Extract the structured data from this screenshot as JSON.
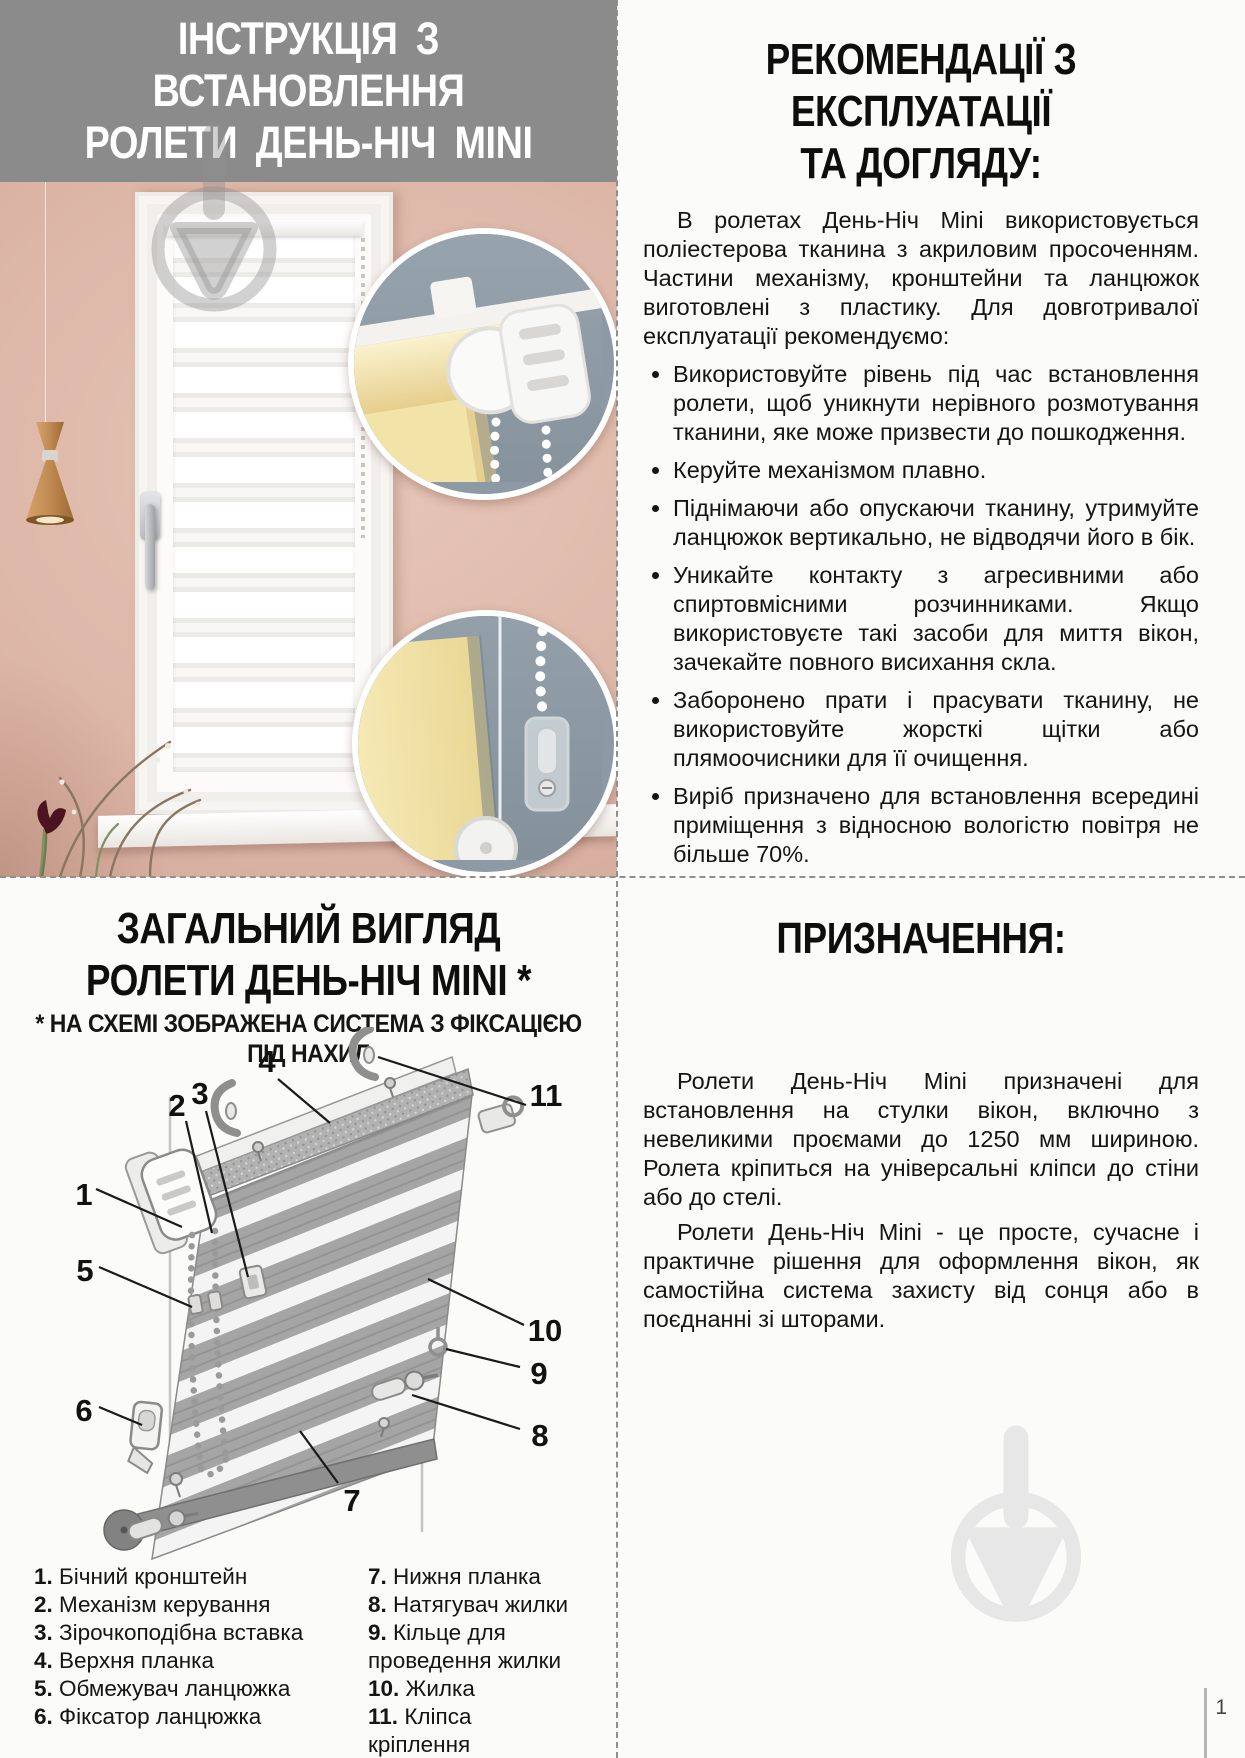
{
  "page": {
    "number": "1"
  },
  "colors": {
    "header_gray": "#8b8b8b",
    "wall_pink": "#dcb5a6",
    "inset_slate": "#8d99a4",
    "blind_yellow": "#f3e5ad",
    "watermark_gray": "#e9e9e9",
    "text": "#151515"
  },
  "install_header": {
    "line1": "ІНСТРУКЦІЯ З ВСТАНОВЛЕННЯ",
    "line2": "РОЛЕТИ ДЕНЬ-НІЧ MINI"
  },
  "recommendations": {
    "title_line1": "РЕКОМЕНДАЦІЇ З ЕКСПЛУАТАЦІЇ",
    "title_line2": "ТА ДОГЛЯДУ:",
    "intro": "В ролетах День-Ніч Mini використовується поліестерова тканина з акриловим просоченням. Частини механізму, кронштейни та ланцюжок виготовлені з пластику. Для довготривалої експлуатації рекомендуємо:",
    "bullets": [
      "Використовуйте рівень під час встановлення ролети, щоб уникнути нерівного розмотування тканини, яке може призвести до пошкодження.",
      "Керуйте механізмом плавно.",
      "Піднімаючи або опускаючи тканину, утримуйте ланцюжок вертикально, не відводячи його в бік.",
      "Уникайте контакту з агресивними або спиртовмісними розчинниками. Якщо використовуєте такі засоби для миття вікон, зачекайте повного висихання скла.",
      "Заборонено прати і прасувати тканину, не використовуйте жорсткі щітки або плямоочисники для її очищення.",
      "Виріб призначено для встановлення всередині приміщення з відносною вологістю повітря не більше 70%.",
      "Рекомендується проводити сухе чищення м'якою щіткою або використовувати пилосмок."
    ]
  },
  "overview": {
    "title_line1": "ЗАГАЛЬНИЙ ВИГЛЯД",
    "title_line2": "РОЛЕТИ ДЕНЬ-НІЧ MINI *",
    "subtitle": "* НА СХЕМІ ЗОБРАЖЕНА СИСТЕМА З ФІКСАЦІЄЮ ПІД НАХИЛ",
    "callouts": [
      "1",
      "2",
      "3",
      "4",
      "5",
      "6",
      "7",
      "8",
      "9",
      "10",
      "11"
    ],
    "legend_left": [
      {
        "num": "1.",
        "label": "Бічний кронштейн"
      },
      {
        "num": "2.",
        "label": "Механізм керування"
      },
      {
        "num": "3.",
        "label": "Зірочкоподібна вставка"
      },
      {
        "num": "4.",
        "label": "Верхня планка"
      },
      {
        "num": "5.",
        "label": "Обмежувач ланцюжка"
      },
      {
        "num": "6.",
        "label": "Фіксатор ланцюжка"
      }
    ],
    "legend_right": [
      {
        "num": "7.",
        "label": "Нижня планка"
      },
      {
        "num": "8.",
        "label": "Натягувач жилки"
      },
      {
        "num": "9.",
        "label": "Кільце для проведення жилки"
      },
      {
        "num": "10.",
        "label": "Жилка"
      },
      {
        "num": "11.",
        "label": "Кліпса кріплення"
      }
    ]
  },
  "purpose": {
    "title": "ПРИЗНАЧЕННЯ:",
    "paragraph1": "Ролети День-Ніч Mini призначені для встановлення на стулки вікон, включно з невеликими проємами до 1250 мм шириною. Ролета кріпиться на універсальні кліпси до стіни або до стелі.",
    "paragraph2": "Ролети День-Ніч Mini - це просте, сучасне і практичне рішення для оформлення вікон, як самостійна система захисту від сонця або в поєднанні зі шторами."
  }
}
